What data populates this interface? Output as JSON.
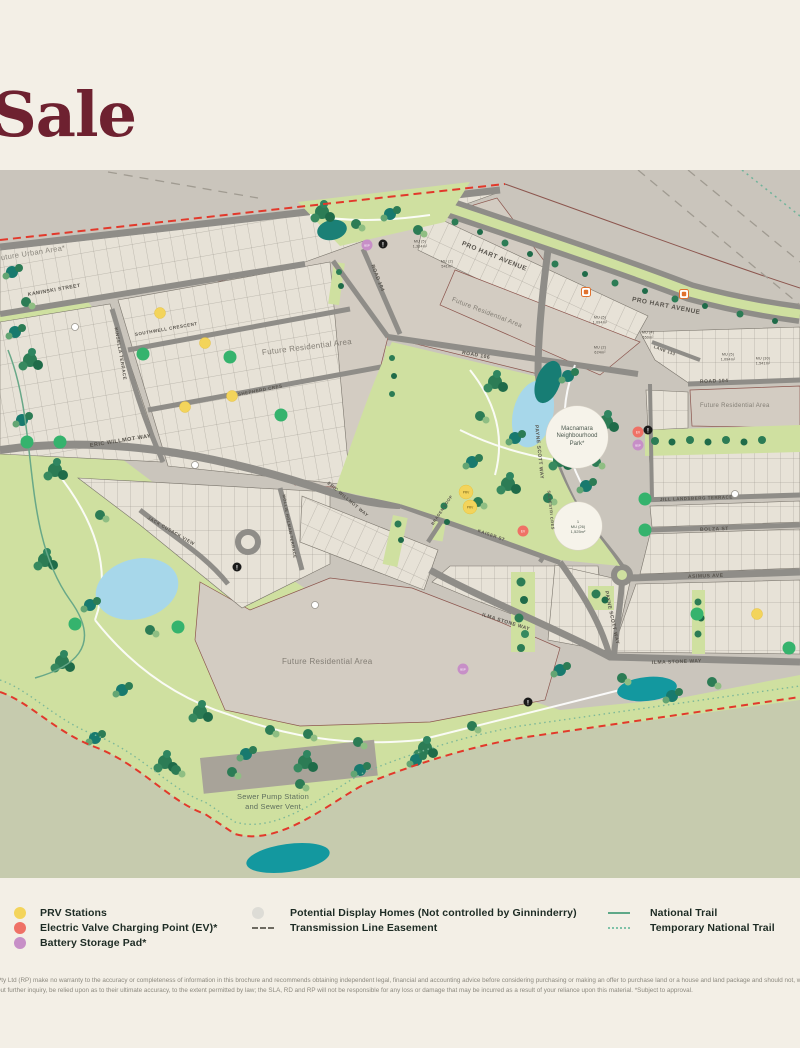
{
  "title": "Sale",
  "map": {
    "outside_label": "Future Urban Area*",
    "marker_text": {
      "prv": "PRV",
      "ev": "EV",
      "bsp": "BSP",
      "info": "!"
    },
    "streets": [
      {
        "name": "PRO HART AVENUE"
      },
      {
        "name": "PRO HART AVENUE"
      },
      {
        "name": "KAMINSKI STREET"
      },
      {
        "name": "SOUTHWELL CRESCENT"
      },
      {
        "name": "SHEPHERD CRES"
      },
      {
        "name": "KINSELLA TERRACE"
      },
      {
        "name": "ERIC WILLMOT WAY"
      },
      {
        "name": "ERIC WILLMOT WAY"
      },
      {
        "name": "JACK CUSACK VIEW"
      },
      {
        "name": "MOLLIE HOLMAN TERRACE"
      },
      {
        "name": "PAYNE SCOTT WAY"
      },
      {
        "name": "PAYNE SCOTT WAY"
      },
      {
        "name": "ROAD 106"
      },
      {
        "name": "ROAD 104"
      },
      {
        "name": "ROAD 104"
      },
      {
        "name": "LANE 133"
      },
      {
        "name": "KAISER ST"
      },
      {
        "name": "SILVESTRI CRES"
      },
      {
        "name": "BRADEN LOOP"
      },
      {
        "name": "ILMA STONE WAY"
      },
      {
        "name": "ILMA STONE WAY"
      },
      {
        "name": "ASIMUS AVE"
      },
      {
        "name": "JILL LANDSBERG TERRACE"
      },
      {
        "name": "BOLZA ST"
      }
    ],
    "areas": [
      {
        "text": "Future Residential Area"
      },
      {
        "text": "Future Residential Area"
      },
      {
        "text": "Future Residential Area"
      },
      {
        "text": "Future Residential Area"
      }
    ],
    "park_circle": {
      "l1": "Macnamara",
      "l2": "Neighbourhood",
      "l3": "Park*"
    },
    "mu26": {
      "num": "1",
      "name": "MU (26)",
      "size": "1,525m²"
    },
    "mu_labels": [
      {
        "name": "MU (5)",
        "size": "1,334m²"
      },
      {
        "name": "MU (2)",
        "size": "541m²"
      },
      {
        "name": "MU (5)",
        "size": "1,094m²"
      },
      {
        "name": "MU (2)",
        "size": "624m²"
      },
      {
        "name": "MU (4)",
        "size": "650m²"
      },
      {
        "name": "MU (5)",
        "size": "1,094m²"
      },
      {
        "name": "MU (30)",
        "size": "1,541m²"
      }
    ],
    "sewer": {
      "l1": "Sewer Pump Station",
      "l2": "and Sewer Vent"
    }
  },
  "legend": {
    "col1": [
      {
        "label": "PRV Stations",
        "swatch": "#f3d45b"
      },
      {
        "label": "Electric Valve Charging Point (EV)*",
        "swatch": "#ef7166"
      },
      {
        "label": "Battery Storage Pad*",
        "swatch": "#c78fc7"
      }
    ],
    "col2": [
      {
        "label": "Potential Display Homes (Not controlled by Ginninderry)",
        "swatch": "#dddcd6"
      },
      {
        "label": "Transmission Line Easement",
        "swatch": "dash"
      }
    ],
    "col3": [
      {
        "label": "National Trail",
        "swatch": "line"
      },
      {
        "label": "Temporary National Trail",
        "swatch": "dots"
      }
    ]
  },
  "disclaimer": {
    "line1": "Pty Ltd (RP) make no warranty to the accuracy or completeness of information in this brochure and recommends obtaining independent legal, financial and accounting advice before considering purchasing or making an offer to purchase land or a house and land package and should not, without further inquiry, be relied upon.",
    "line2": "out further inquiry, be relied upon as to their ultimate accuracy, to the extent permitted by law; the SLA, RD and RP will not be responsible for any loss or damage that may be incurred as a result of your reliance upon this material. *Subject to approval."
  },
  "colors": {
    "page_bg": "#f3efe6",
    "title": "#6e2130",
    "outside_gray": "#cac5bc",
    "outside_green": "#c6cbae",
    "park_green": "#cfe0a0",
    "lot_beige": "#e7e2d7",
    "future_taupe": "#d3ccc2",
    "road": "#8f8d88",
    "boundary_red": "#e2392b",
    "pond_blue": "#a7d7ea",
    "pond_teal": "#13989f",
    "prv": "#f3d45b",
    "ev": "#ef7166",
    "bsp": "#c78fc7",
    "trail": "#5ea888"
  }
}
